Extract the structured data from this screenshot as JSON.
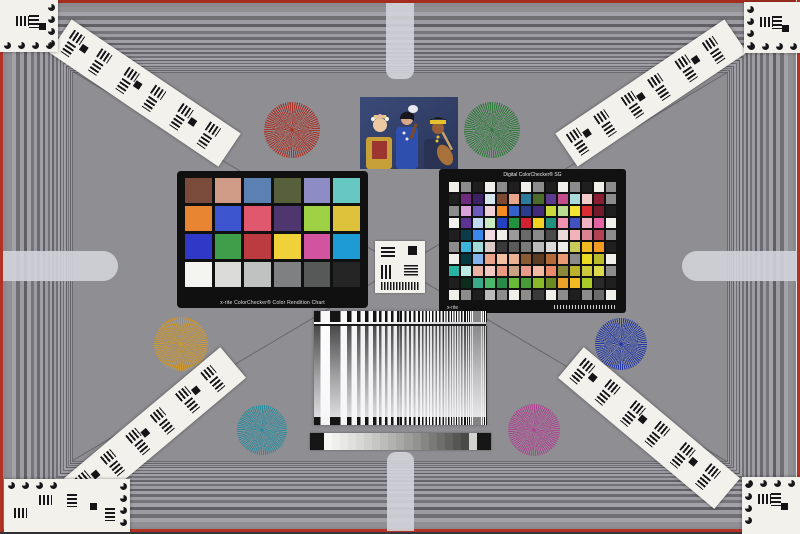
{
  "scene": {
    "description": "Camera lens test chart scene with resolution frame, Siemens stars, ColorChecker charts, sweep target and step wedge",
    "background_color": "#8e8e93",
    "edge_accent_red": "#b23226"
  },
  "colorchecker_classic": {
    "caption": "x-rite ColorChecker® Color Rendition Chart",
    "rows": [
      [
        "#7a4b3a",
        "#cf9a86",
        "#5b80b2",
        "#56613b",
        "#8e8cc4",
        "#66c8c0"
      ],
      [
        "#e88532",
        "#3d55ce",
        "#e0586e",
        "#50366f",
        "#9ed044",
        "#dfc23c"
      ],
      [
        "#3038c8",
        "#3f9e4a",
        "#bc3b41",
        "#efd23a",
        "#d2539f",
        "#1f9bd4"
      ],
      [
        "#f4f4f1",
        "#dbdbd9",
        "#c0c1c1",
        "#7f8081",
        "#575858",
        "#252526"
      ]
    ]
  },
  "colorchecker_sg": {
    "title": "Digital ColorChecker® SG",
    "brand": "x-rite",
    "rows": [
      [
        "#f0efe9",
        "#8c8c8c",
        "#1f1f1f",
        "#f0efe9",
        "#8c8c8c",
        "#1f1f1f",
        "#f0efe9",
        "#8c8c8c",
        "#1f1f1f",
        "#f0efe9",
        "#8c8c8c",
        "#1f1f1f",
        "#f0efe9",
        "#8c8c8c"
      ],
      [
        "#1f1f1f",
        "#6e2a7e",
        "#3c2264",
        "#d6e6f0",
        "#7c4a30",
        "#eaa488",
        "#2e7c9c",
        "#4c6c2c",
        "#5c3c8c",
        "#c24c8c",
        "#aadada",
        "#f2caca",
        "#8c1c32",
        "#8c8c8c"
      ],
      [
        "#8c8c8c",
        "#daa2da",
        "#6c5aba",
        "#f2d2da",
        "#f28c22",
        "#3262ca",
        "#2a3c8c",
        "#422a7c",
        "#cada3a",
        "#badb92",
        "#f2e232",
        "#da2a32",
        "#721a2a",
        "#1f1f1f"
      ],
      [
        "#f0efe9",
        "#5c3292",
        "#c2daf2",
        "#caeac2",
        "#2242c2",
        "#22923f",
        "#d22232",
        "#f2d222",
        "#22927f",
        "#f292b2",
        "#4252c2",
        "#f2b2c2",
        "#e262a2",
        "#f0efe9"
      ],
      [
        "#1f1f1f",
        "#0c3c4c",
        "#3a86ea",
        "#f2dae2",
        "#f0efe9",
        "#9a9a9a",
        "#6a6a6a",
        "#8a8a8a",
        "#4a4a4a",
        "#eadada",
        "#f2b2ba",
        "#da8292",
        "#b24252",
        "#8c8c8c"
      ],
      [
        "#8c8c8c",
        "#3ab2da",
        "#a2dada",
        "#dacaca",
        "#3a3a3a",
        "#5a5a5a",
        "#7a7a7a",
        "#bababa",
        "#dadada",
        "#eaeaea",
        "#caca5a",
        "#f2ba22",
        "#f29a22",
        "#1f1f1f"
      ],
      [
        "#f0efe9",
        "#063a42",
        "#82b2ea",
        "#eaa28a",
        "#f2c2a2",
        "#eab292",
        "#8a5a32",
        "#5c3c22",
        "#b26a3a",
        "#ea9a72",
        "#8a8a8a",
        "#eada22",
        "#baba2a",
        "#f0efe9"
      ],
      [
        "#2ab2a2",
        "#baeae2",
        "#eab2a2",
        "#f2cac2",
        "#ea9a82",
        "#caa282",
        "#ea9a8a",
        "#f2baa2",
        "#ea8a6a",
        "#8a8a3a",
        "#bab22a",
        "#caca3a",
        "#dada4a",
        "#8c8c8c"
      ],
      [
        "#1f1f1f",
        "#0c2c1c",
        "#3aaa8a",
        "#4aba6a",
        "#2a8a4a",
        "#6aba3a",
        "#4a9a3a",
        "#8aba2a",
        "#6a8a22",
        "#eaa22a",
        "#f2ba22",
        "#aaca2a",
        "#2a2a2a",
        "#1f1f1f"
      ],
      [
        "#f0efe9",
        "#8c8c8c",
        "#1f1f1f",
        "#bababa",
        "#8c8c8c",
        "#f0efe9",
        "#8c8c8c",
        "#3a3a3a",
        "#f0efe9",
        "#8c8c8c",
        "#1f1f1f",
        "#8c8c8c",
        "#6a6a6a",
        "#f0efe9"
      ]
    ]
  },
  "siemens_stars": [
    {
      "name": "red",
      "color": "#a83226",
      "cx": 292,
      "cy": 130,
      "r": 28
    },
    {
      "name": "green",
      "color": "#2e7a38",
      "cx": 492,
      "cy": 130,
      "r": 28
    },
    {
      "name": "orange",
      "color": "#cf982e",
      "cx": 181,
      "cy": 344,
      "r": 27
    },
    {
      "name": "blue",
      "color": "#2438a6",
      "cx": 621,
      "cy": 344,
      "r": 26
    },
    {
      "name": "teal",
      "color": "#2b8c9c",
      "cx": 262,
      "cy": 430,
      "r": 25
    },
    {
      "name": "magenta",
      "color": "#ae4390",
      "cx": 534,
      "cy": 430,
      "r": 26
    }
  ],
  "step_wedge": {
    "cap_color": "#161616",
    "steps": [
      "#f6f6f4",
      "#efefed",
      "#e8e8e6",
      "#e0e0de",
      "#d8d8d6",
      "#cfcfcd",
      "#c6c6c4",
      "#bcbcba",
      "#b2b2b0",
      "#a8a8a6",
      "#9d9d9b",
      "#929290",
      "#868684",
      "#7a7a78",
      "#6e6e6c",
      "#626260",
      "#565654",
      "#4a4a48",
      "#d2d2d0"
    ]
  },
  "sweep": {
    "periods": [
      16,
      11,
      8,
      6,
      4.5,
      3.4,
      2.6,
      2.1
    ]
  },
  "frame": {
    "rings": [
      {
        "w": 5,
        "c": "#8f8f94"
      },
      {
        "w": 4,
        "c": "#a2a2a8"
      },
      {
        "w": 4,
        "c": "#6f6f74"
      },
      {
        "w": 4,
        "c": "#9c9ca2"
      },
      {
        "w": 3,
        "c": "#5f5f64"
      },
      {
        "w": 4,
        "c": "#a2a2a8"
      },
      {
        "w": 3,
        "c": "#75757a"
      },
      {
        "w": 3,
        "c": "#9c9ca2"
      },
      {
        "w": 3,
        "c": "#6a6a70"
      },
      {
        "w": 3,
        "c": "#a0a0a6"
      },
      {
        "w": 2,
        "c": "#606066"
      },
      {
        "w": 3,
        "c": "#9a9aa0"
      },
      {
        "w": 2,
        "c": "#727278"
      },
      {
        "w": 2,
        "c": "#a0a0a6"
      },
      {
        "w": 2,
        "c": "#64646a"
      },
      {
        "w": 2,
        "c": "#9a9aa0"
      },
      {
        "w": 2,
        "c": "#707076"
      },
      {
        "w": 2,
        "c": "#a2a2a8"
      },
      {
        "w": 1,
        "c": "#5c5c62"
      },
      {
        "w": 2,
        "c": "#9a9aa0"
      },
      {
        "w": 1,
        "c": "#6e6e74"
      },
      {
        "w": 2,
        "c": "#a0a0a6"
      },
      {
        "w": 1,
        "c": "#606066"
      },
      {
        "w": 1,
        "c": "#9a9aa0"
      },
      {
        "w": 1,
        "c": "#727278"
      },
      {
        "w": 1,
        "c": "#9c9ca2"
      },
      {
        "w": 1,
        "c": "#64646a"
      },
      {
        "w": 1,
        "c": "#98989e"
      }
    ]
  },
  "diagonal_lines": [
    {
      "x2": 73,
      "y2": 72
    },
    {
      "x2": 727,
      "y2": 72
    },
    {
      "x2": 73,
      "y2": 461
    },
    {
      "x2": 727,
      "y2": 461
    }
  ],
  "strips": [
    {
      "name": "top-left",
      "cx": 145,
      "cy": 93,
      "angle": 34
    },
    {
      "name": "top-right",
      "cx": 651,
      "cy": 93,
      "angle": -34
    },
    {
      "name": "bottom-left",
      "cx": 155,
      "cy": 428,
      "angle": -40
    },
    {
      "name": "bottom-right",
      "cx": 649,
      "cy": 428,
      "angle": 40
    }
  ],
  "corner_cards": [
    {
      "corner": "tl",
      "x": 0,
      "y": 0,
      "w": 58,
      "h": 52
    },
    {
      "corner": "tr",
      "x": 744,
      "y": 2,
      "w": 56,
      "h": 51
    },
    {
      "corner": "bl",
      "x": 4,
      "y": 479,
      "w": 126,
      "h": 53
    },
    {
      "corner": "br",
      "x": 742,
      "y": 477,
      "w": 58,
      "h": 57
    }
  ]
}
